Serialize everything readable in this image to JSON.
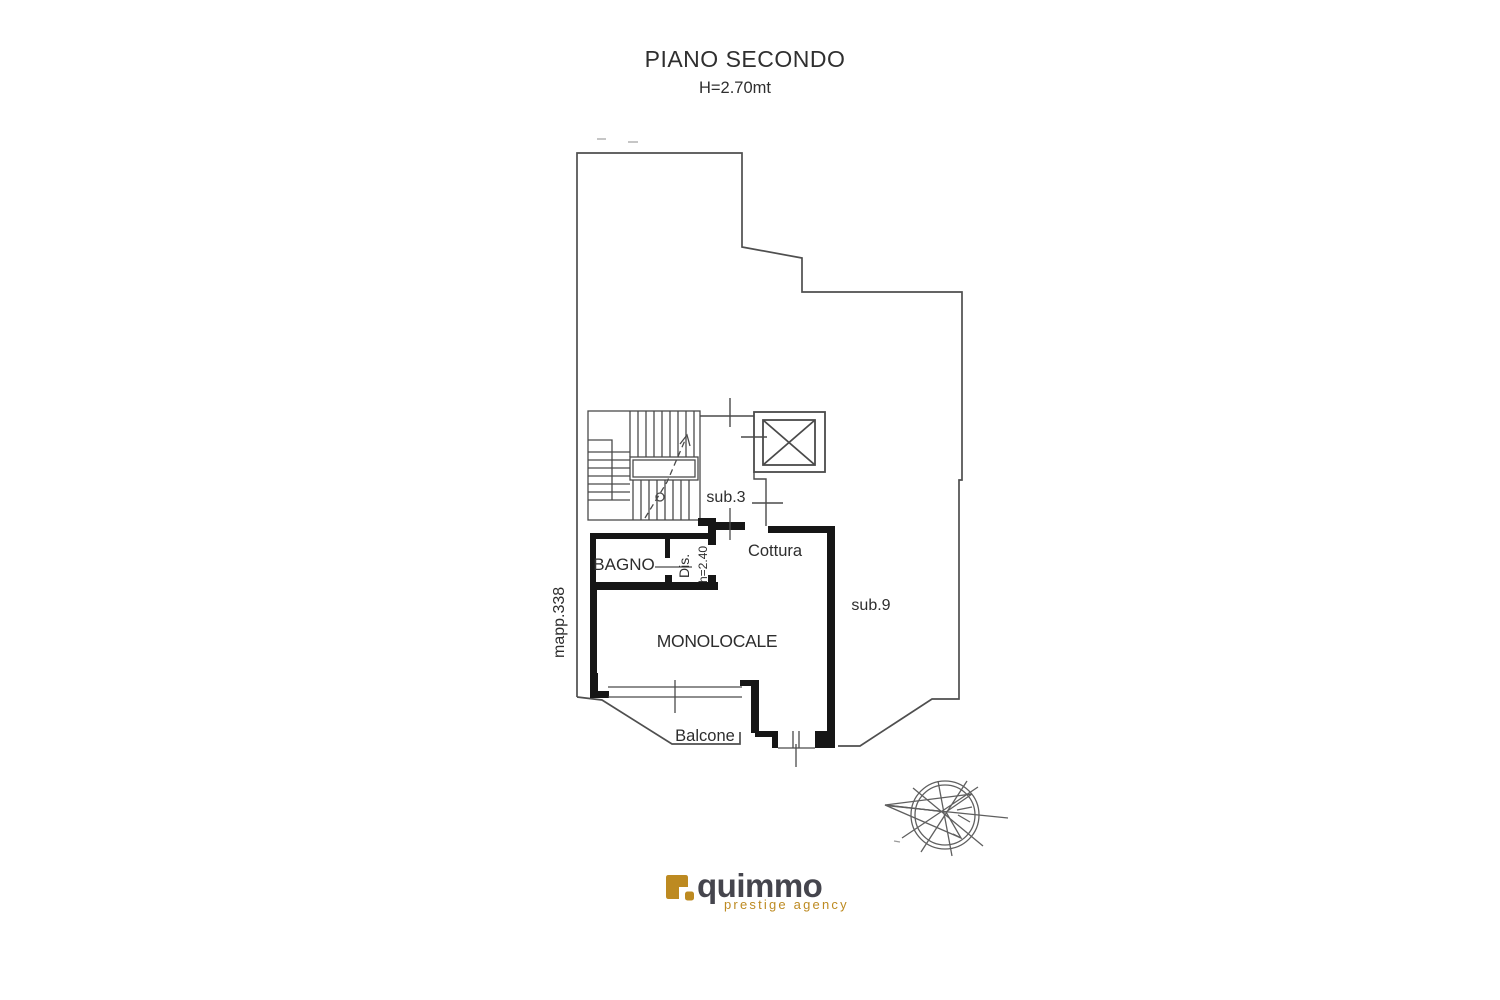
{
  "header": {
    "title": "PIANO SECONDO",
    "height_note": "H=2.70mt"
  },
  "plan": {
    "labels": {
      "sub3": "sub.3",
      "sub9": "sub.9",
      "bagno": "BAGNO",
      "dis": "Dis.",
      "dis_height": "h=2.40",
      "cottura": "Cottura",
      "monolocale": "MONOLOCALE",
      "balcone": "Balcone",
      "mapp": "mapp.338"
    }
  },
  "logo": {
    "brand": "quimmo",
    "tagline": "prestige agency",
    "accent_color": "#bd8a21",
    "brand_color": "#45454d"
  },
  "colors": {
    "line": "#4a4a4a",
    "wall": "#161616",
    "text": "#2d2d2d",
    "background": "#ffffff"
  }
}
